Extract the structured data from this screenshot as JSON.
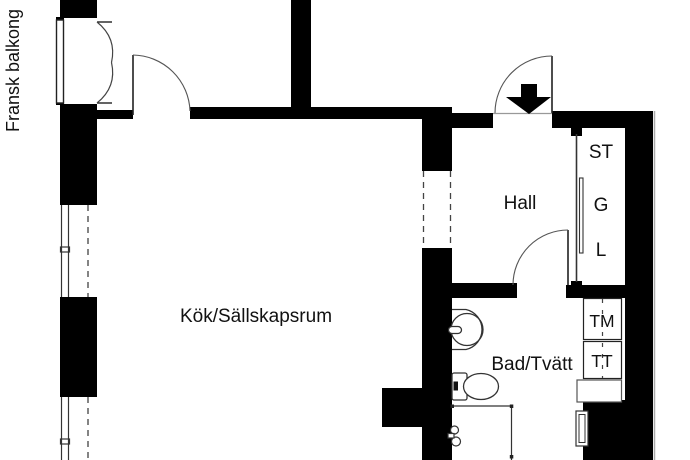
{
  "floorplan": {
    "labels": {
      "french_balcony": "Fransk balkong",
      "kitchen_living": "Kök/Sällskapsrum",
      "hall": "Hall",
      "bath_laundry": "Bad/Tvätt",
      "closet_st": "ST",
      "closet_g": "G",
      "closet_l": "L",
      "washing_machine": "TM",
      "tumble_dryer": "TT"
    },
    "colors": {
      "wall": "#000000",
      "background": "#ffffff",
      "line": "#333333"
    }
  }
}
